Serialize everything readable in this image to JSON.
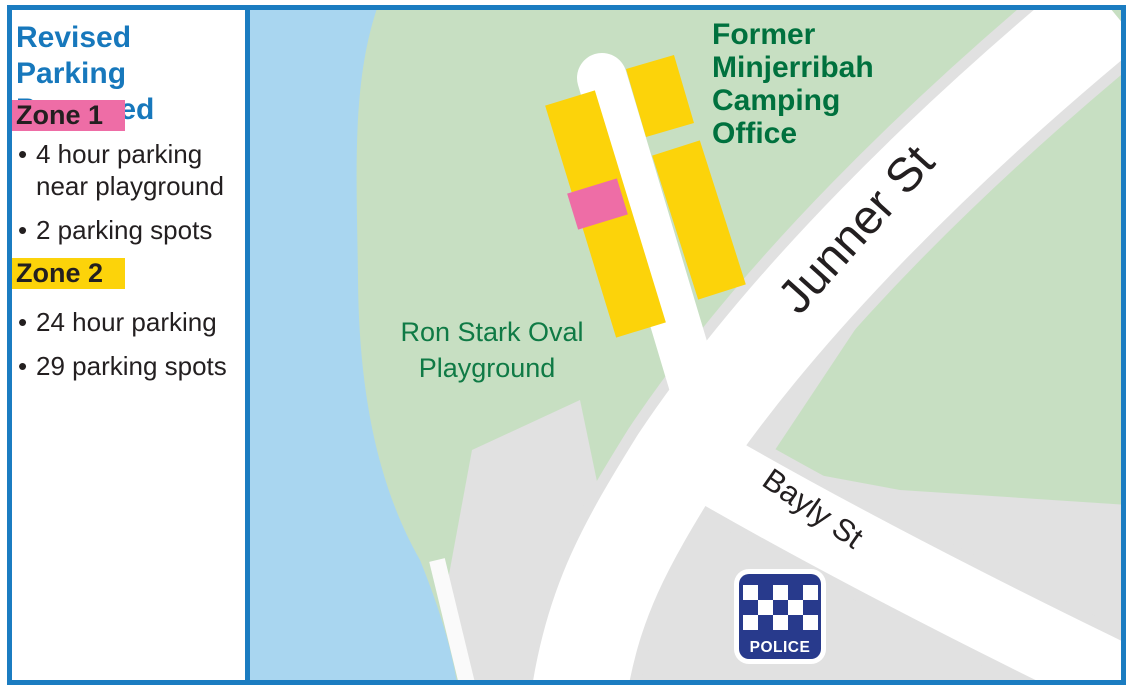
{
  "frame": {
    "border_color": "#1b7cc1"
  },
  "sidebar": {
    "title": "Revised Parking Proposed",
    "title_color": "#1778bc",
    "bullet_char": "•",
    "zones": [
      {
        "label": "Zone 1",
        "highlight_color": "#ee6da6",
        "bullets": [
          "4 hour parking near playground",
          "2 parking spots"
        ]
      },
      {
        "label": "Zone 2",
        "highlight_color": "#fcd30a",
        "bullets": [
          "24 hour parking",
          "29 parking spots"
        ]
      }
    ]
  },
  "map": {
    "colors": {
      "park_green": "#c7dfc2",
      "water_blue": "#a9d6f0",
      "parcel_gray": "#e1e1e1",
      "road_white": "#ffffff",
      "zone1_pink": "#ee6da6",
      "zone2_yellow": "#fcd30a",
      "camping_label_green": "#00713e",
      "oval_label_green": "#0f7a45",
      "street_label_black": "#231f20",
      "police_navy": "#283a8c"
    },
    "labels": {
      "camping_office_lines": [
        "Former",
        "Minjerribah",
        "Camping",
        "Office"
      ],
      "oval_lines": [
        "Ron Stark Oval",
        "Playground"
      ],
      "street_junner": "Junner St",
      "street_bayly": "Bayly St",
      "police": "POLICE"
    }
  }
}
